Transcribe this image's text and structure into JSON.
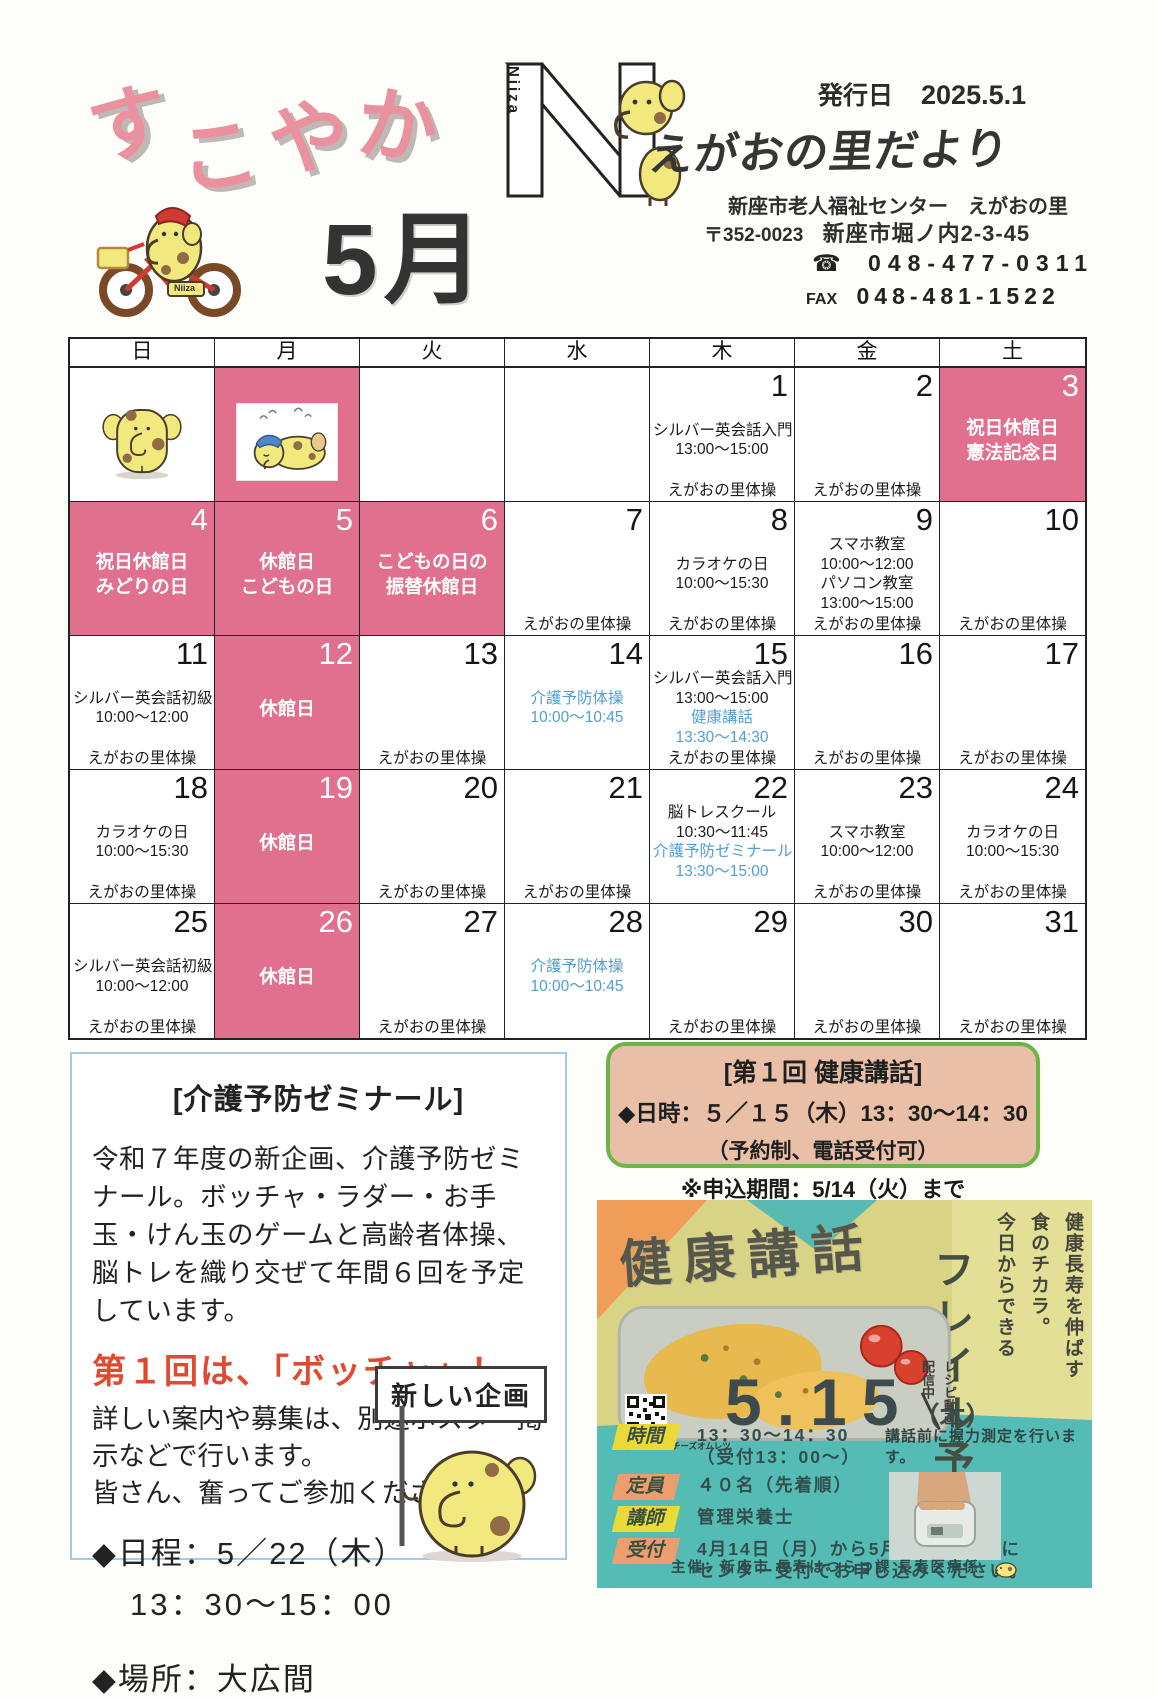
{
  "header": {
    "newsletter_title": "すこやか",
    "month": "5月",
    "issue_label": "発行日",
    "issue_date": "2025.5.1",
    "logo_letter": "N",
    "logo_vertical": "Niiza",
    "bike_plate": "Niiza",
    "publication_title": "えがおの里だより",
    "org": "新座市老人福祉センター　えがおの里",
    "postal": "〒352-0023",
    "address": "新座市堀ノ内2-3-45",
    "tel_icon": "☎",
    "tel": "048-477-0311",
    "fax_label": "FAX",
    "fax": "048-481-1522"
  },
  "calendar": {
    "weekdays": [
      "日",
      "月",
      "火",
      "水",
      "木",
      "金",
      "土"
    ],
    "closed_color": "#e0708e",
    "highlight_color": "#4f9fd4",
    "cells": [
      {
        "img": "standing"
      },
      {
        "img": "sleeping",
        "closed": true
      },
      {},
      {},
      {
        "day": "1",
        "events": [
          {
            "t": "シルバー英会話入門"
          },
          {
            "t": "13:00～15:00"
          }
        ],
        "taiso": "えがおの里体操"
      },
      {
        "day": "2",
        "taiso": "えがおの里体操"
      },
      {
        "day": "3",
        "closed": true,
        "events": [
          {
            "t": "祝日休館日"
          },
          {
            "t": "憲法記念日"
          }
        ]
      },
      {
        "day": "4",
        "closed": true,
        "events": [
          {
            "t": "祝日休館日"
          },
          {
            "t": "みどりの日"
          }
        ]
      },
      {
        "day": "5",
        "closed": true,
        "events": [
          {
            "t": "休館日"
          },
          {
            "t": "こどもの日"
          }
        ]
      },
      {
        "day": "6",
        "closed": true,
        "events": [
          {
            "t": "こどもの日の"
          },
          {
            "t": "振替休館日"
          }
        ]
      },
      {
        "day": "7",
        "taiso": "えがおの里体操"
      },
      {
        "day": "8",
        "events": [
          {
            "t": "カラオケの日"
          },
          {
            "t": "10:00～15:30"
          }
        ],
        "taiso": "えがおの里体操"
      },
      {
        "day": "9",
        "events": [
          {
            "t": "スマホ教室"
          },
          {
            "t": "10:00～12:00"
          },
          {
            "t": "パソコン教室"
          },
          {
            "t": "13:00～15:00"
          }
        ],
        "taiso": "えがおの里体操"
      },
      {
        "day": "10",
        "taiso": "えがおの里体操"
      },
      {
        "day": "11",
        "events": [
          {
            "t": "シルバー英会話初級"
          },
          {
            "t": "10:00～12:00"
          }
        ],
        "taiso": "えがおの里体操"
      },
      {
        "day": "12",
        "closed": true,
        "events": [
          {
            "t": "休館日"
          }
        ]
      },
      {
        "day": "13",
        "taiso": "えがおの里体操"
      },
      {
        "day": "14",
        "events": [
          {
            "t": "介護予防体操",
            "c": "blue"
          },
          {
            "t": "10:00～10:45",
            "c": "blue"
          }
        ]
      },
      {
        "day": "15",
        "events": [
          {
            "t": "シルバー英会話入門"
          },
          {
            "t": "13:00～15:00"
          },
          {
            "t": "健康講話",
            "c": "blue"
          },
          {
            "t": "13:30～14:30",
            "c": "blue"
          }
        ],
        "taiso": "えがおの里体操"
      },
      {
        "day": "16",
        "taiso": "えがおの里体操"
      },
      {
        "day": "17",
        "taiso": "えがおの里体操"
      },
      {
        "day": "18",
        "events": [
          {
            "t": "カラオケの日"
          },
          {
            "t": "10:00～15:30"
          }
        ],
        "taiso": "えがおの里体操"
      },
      {
        "day": "19",
        "closed": true,
        "events": [
          {
            "t": "休館日"
          }
        ]
      },
      {
        "day": "20",
        "taiso": "えがおの里体操"
      },
      {
        "day": "21",
        "taiso": "えがおの里体操"
      },
      {
        "day": "22",
        "events": [
          {
            "t": "脳トレスクール"
          },
          {
            "t": "10:30～11:45"
          },
          {
            "t": "介護予防ゼミナール",
            "c": "blue"
          },
          {
            "t": "13:30～15:00",
            "c": "blue"
          }
        ]
      },
      {
        "day": "23",
        "events": [
          {
            "t": "スマホ教室"
          },
          {
            "t": "10:00～12:00"
          }
        ],
        "taiso": "えがおの里体操"
      },
      {
        "day": "24",
        "events": [
          {
            "t": "カラオケの日"
          },
          {
            "t": "10:00～15:30"
          }
        ],
        "taiso": "えがおの里体操"
      },
      {
        "day": "25",
        "events": [
          {
            "t": "シルバー英会話初級"
          },
          {
            "t": "10:00～12:00"
          }
        ],
        "taiso": "えがおの里体操"
      },
      {
        "day": "26",
        "closed": true,
        "events": [
          {
            "t": "休館日"
          }
        ]
      },
      {
        "day": "27",
        "taiso": "えがおの里体操"
      },
      {
        "day": "28",
        "events": [
          {
            "t": "介護予防体操",
            "c": "blue"
          },
          {
            "t": "10:00～10:45",
            "c": "blue"
          }
        ]
      },
      {
        "day": "29",
        "taiso": "えがおの里体操"
      },
      {
        "day": "30",
        "taiso": "えがおの里体操"
      },
      {
        "day": "31",
        "taiso": "えがおの里体操"
      }
    ]
  },
  "seminar_box": {
    "title": "[介護予防ゼミナール]",
    "para1": "令和７年度の新企画、介護予防ゼミナール。ボッチャ・ラダー・お手玉・けん玉のゲームと高齢者体操、脳トレを織り交ぜて年間６回を予定しています。",
    "highlight": "第１回は、「ボッチャ」！",
    "para2": "詳しい案内や募集は、別途ポスター掲示などで行います。",
    "para3": "皆さん、奮ってご参加ください！！",
    "schedule_line1": "◆日程：5／22（木）",
    "schedule_line2": "13：30～15：00",
    "place": "◆場所：大広間",
    "sign": "新しい企画"
  },
  "health_box": {
    "title": "[第１回 健康講話]",
    "datetime": "◆日時：５／１５（木）13：30～14：30",
    "note1": "（予約制、電話受付可）",
    "note2": "※申込期間：5/14（火）まで"
  },
  "poster": {
    "title": "健康講話",
    "tagline_col1": "健康長寿を伸ばす",
    "tagline_col2": "食のチカラ。",
    "tagline_col3": "今日からできる",
    "main_copy": "フレイル予防",
    "recipe_tag1": "レシピ動画",
    "recipe_tag2": "配信中",
    "recipe_caption": "豆腐とキノコのチーズオムレツ",
    "date": "5.15",
    "date_day": "（木）",
    "rows": [
      {
        "label": "時間",
        "value": "13：30～14：30",
        "value2": "（受付13：00～）"
      },
      {
        "label": "定員",
        "value": "４０名（先着順）"
      },
      {
        "label": "講師",
        "value": "管理栄養士"
      },
      {
        "label": "受付",
        "value": "4月14日（月）から5月14日（水）に",
        "value2": "センター受付でお申し込みください。"
      }
    ],
    "grip_note": "講話前に握力測定を行います。",
    "organizer": "主催：新座市 長寿はつらつ課 長寿医療係"
  }
}
